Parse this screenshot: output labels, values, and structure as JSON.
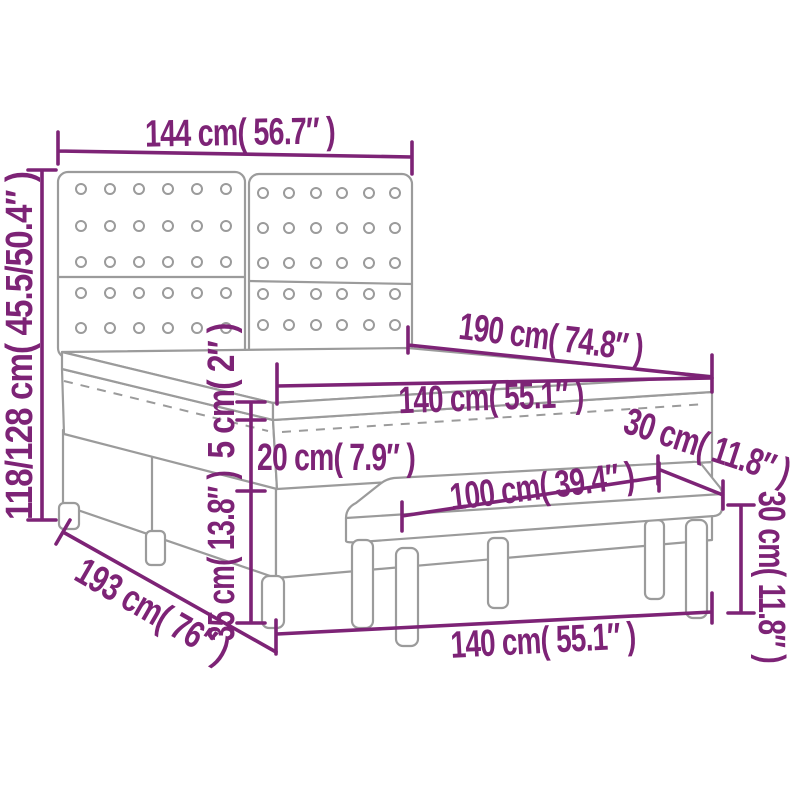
{
  "diagram": {
    "title": "bed-with-bench-dimension-diagram",
    "background_color": "#ffffff",
    "dimension_color": "#7d2376",
    "outline_color": "#9b9b9b",
    "labels": {
      "headboard_width": "144 cm( 56.7″ )",
      "bed_height": "118/128 cm( 45.5/50.4″ )",
      "mattress_length": "190 cm( 74.8″ )",
      "mattress_width": "140 cm( 55.1″ )",
      "topper_thickness": "5 cm( 2″ )",
      "mattress_thickness": "20 cm( 7.9″ )",
      "base_height": "35 cm( 13.8″ )",
      "bench_depth": "30 cm( 11.8″ )",
      "bench_length": "100 cm( 39.4″ )",
      "bench_height": "30 cm( 11.8″ )",
      "base_width": "140 cm( 55.1″ )",
      "base_length": "193 cm( 76″ )"
    },
    "headboard": {
      "button_rows_per_panel": 5,
      "button_cols_per_panel": 6,
      "panels": 2
    }
  }
}
